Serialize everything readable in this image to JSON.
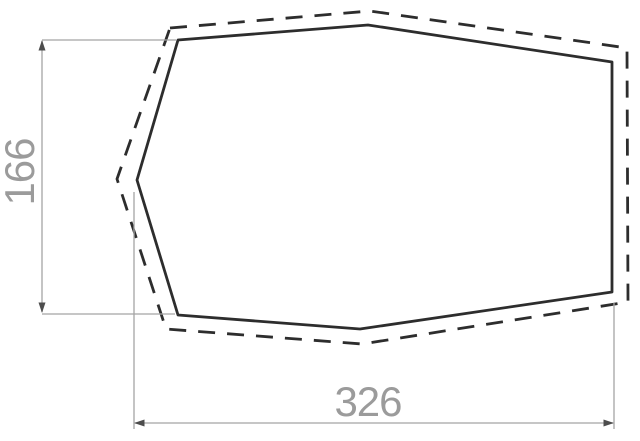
{
  "title": "Footprint dimension diagram",
  "colors": {
    "outline": "#2d2d2d",
    "dashed-outline": "#2d2d2d",
    "dimension-line": "#a4a4a4",
    "arrow": "#4d4d4d",
    "label": "#9b9b9b",
    "background": "#ffffff"
  },
  "dimensions": {
    "height": {
      "label": "166"
    },
    "width": {
      "label": "326"
    }
  },
  "diagram": {
    "solid_outline_points": "178,40 368,25 612,62 612,292 360,329 178,315 137,180",
    "dashed_outline_points": "170,28 370,11 627,48 628,302 362,344 166,329 117,179",
    "height_dimension": {
      "line_points": "42,41 42,312",
      "ext_top_points": "42,40 176,40",
      "ext_bottom_points": "42,314 175,314",
      "arrow_up_points": "42,40 38.5,50.5 45.5,50.5",
      "arrow_down_points": "42,313 38.5,302.5 45.5,302.5"
    },
    "width_dimension": {
      "line_points": "135,423 613,423",
      "ext_left_points": "134,192 134,429",
      "ext_right_points": "614,303 614,429",
      "arrow_left_points": "134,423 144.5,419.5 144.5,426.5",
      "arrow_right_points": "614,423 603.5,419.5 603.5,426.5"
    }
  }
}
